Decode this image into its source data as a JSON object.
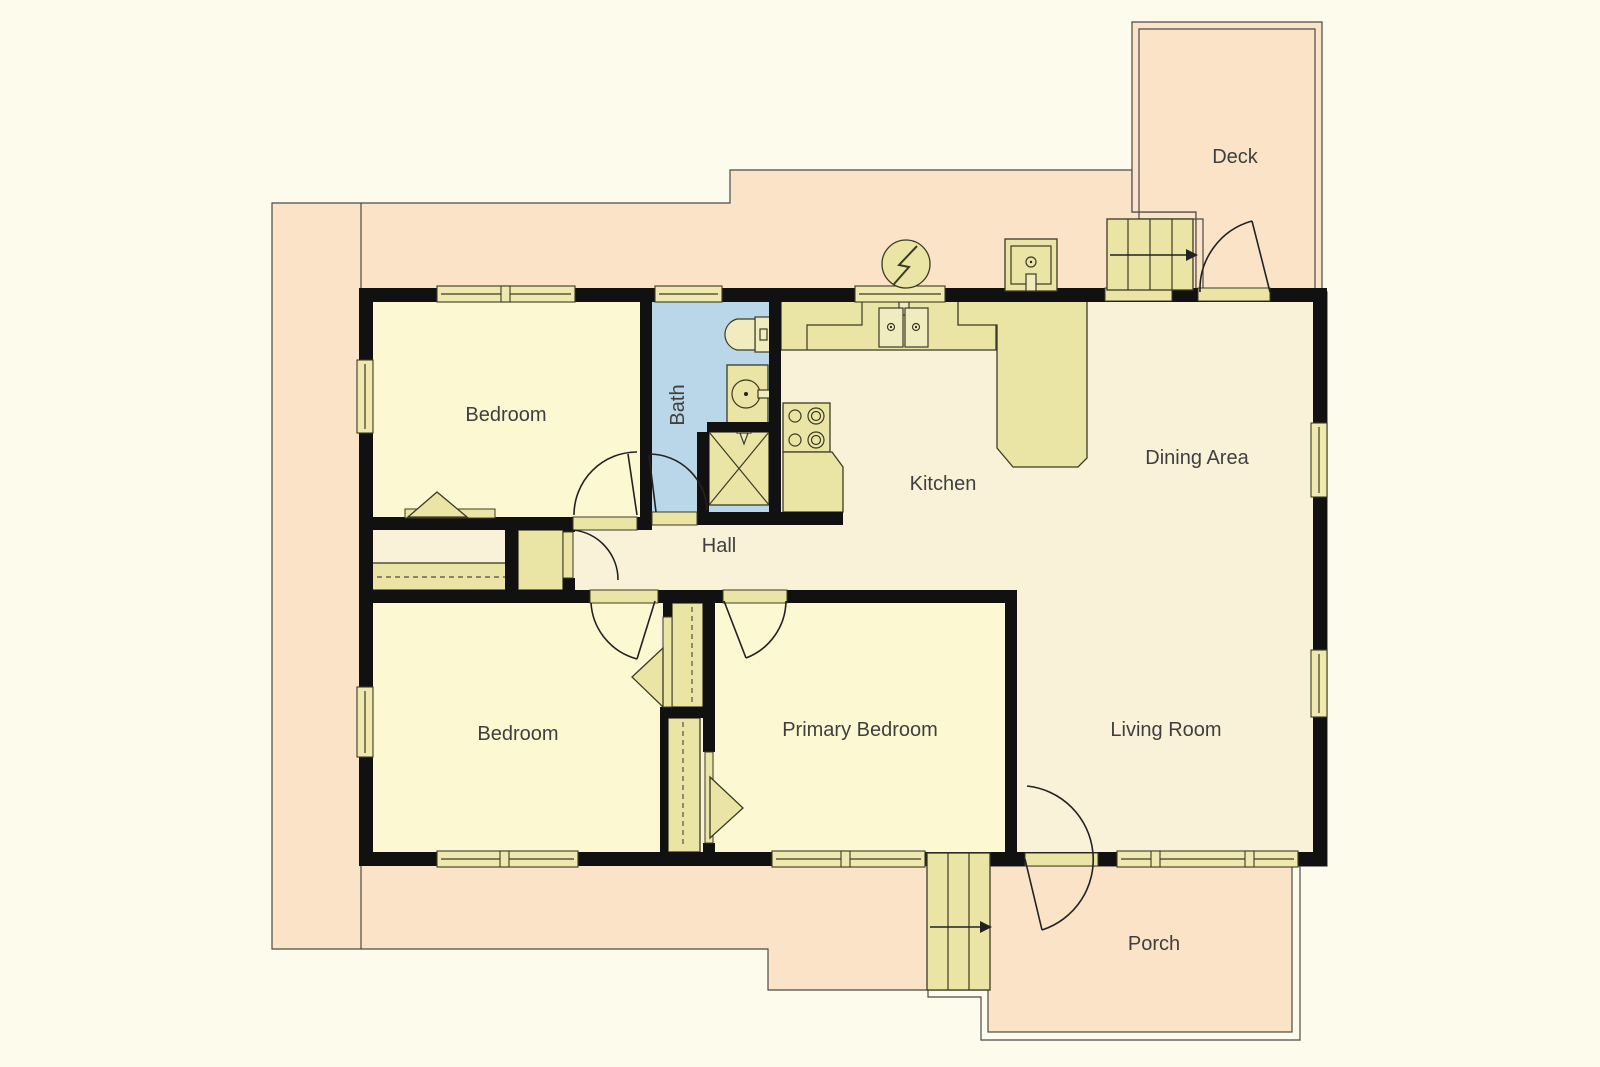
{
  "page": {
    "title": "Floor Plan"
  },
  "colors": {
    "background": "#fdfcec",
    "outdoor_peach": "#fbe3c8",
    "wall_black": "#111111",
    "floor_common": "#faf2d8",
    "floor_room": "#fcf8d1",
    "bath_blue": "#b9d7e8",
    "fixture_yellow": "#eae5a4",
    "fixture_light": "#f1ecbf",
    "window_yellow": "#efe9b0",
    "outline_gray": "#4a4a4a",
    "fixture_stroke": "#3b3b25",
    "arc_line": "#222222",
    "dash_line": "#666655",
    "text": "#3f3f3f"
  },
  "rooms": {
    "deck": "Deck",
    "bedroom_top": "Bedroom",
    "bath": "Bath",
    "kitchen": "Kitchen",
    "dining": "Dining Area",
    "hall": "Hall",
    "bedroom_bottom": "Bedroom",
    "primary_bedroom": "Primary Bedroom",
    "living": "Living Room",
    "porch": "Porch"
  },
  "fixtures": {
    "electric_meter": "electric-meter-icon",
    "utility_panel": "utility-panel-icon",
    "kitchen_sink": "kitchen-sink-icon",
    "stove": "stove-icon",
    "toilet": "toilet-icon",
    "bathroom_sink": "bathroom-sink-icon",
    "shower": "shower-icon",
    "deck_stairs": "stairs-up-icon",
    "porch_stairs": "stairs-up-icon",
    "closet_rod": "closet-rod-dashed"
  }
}
